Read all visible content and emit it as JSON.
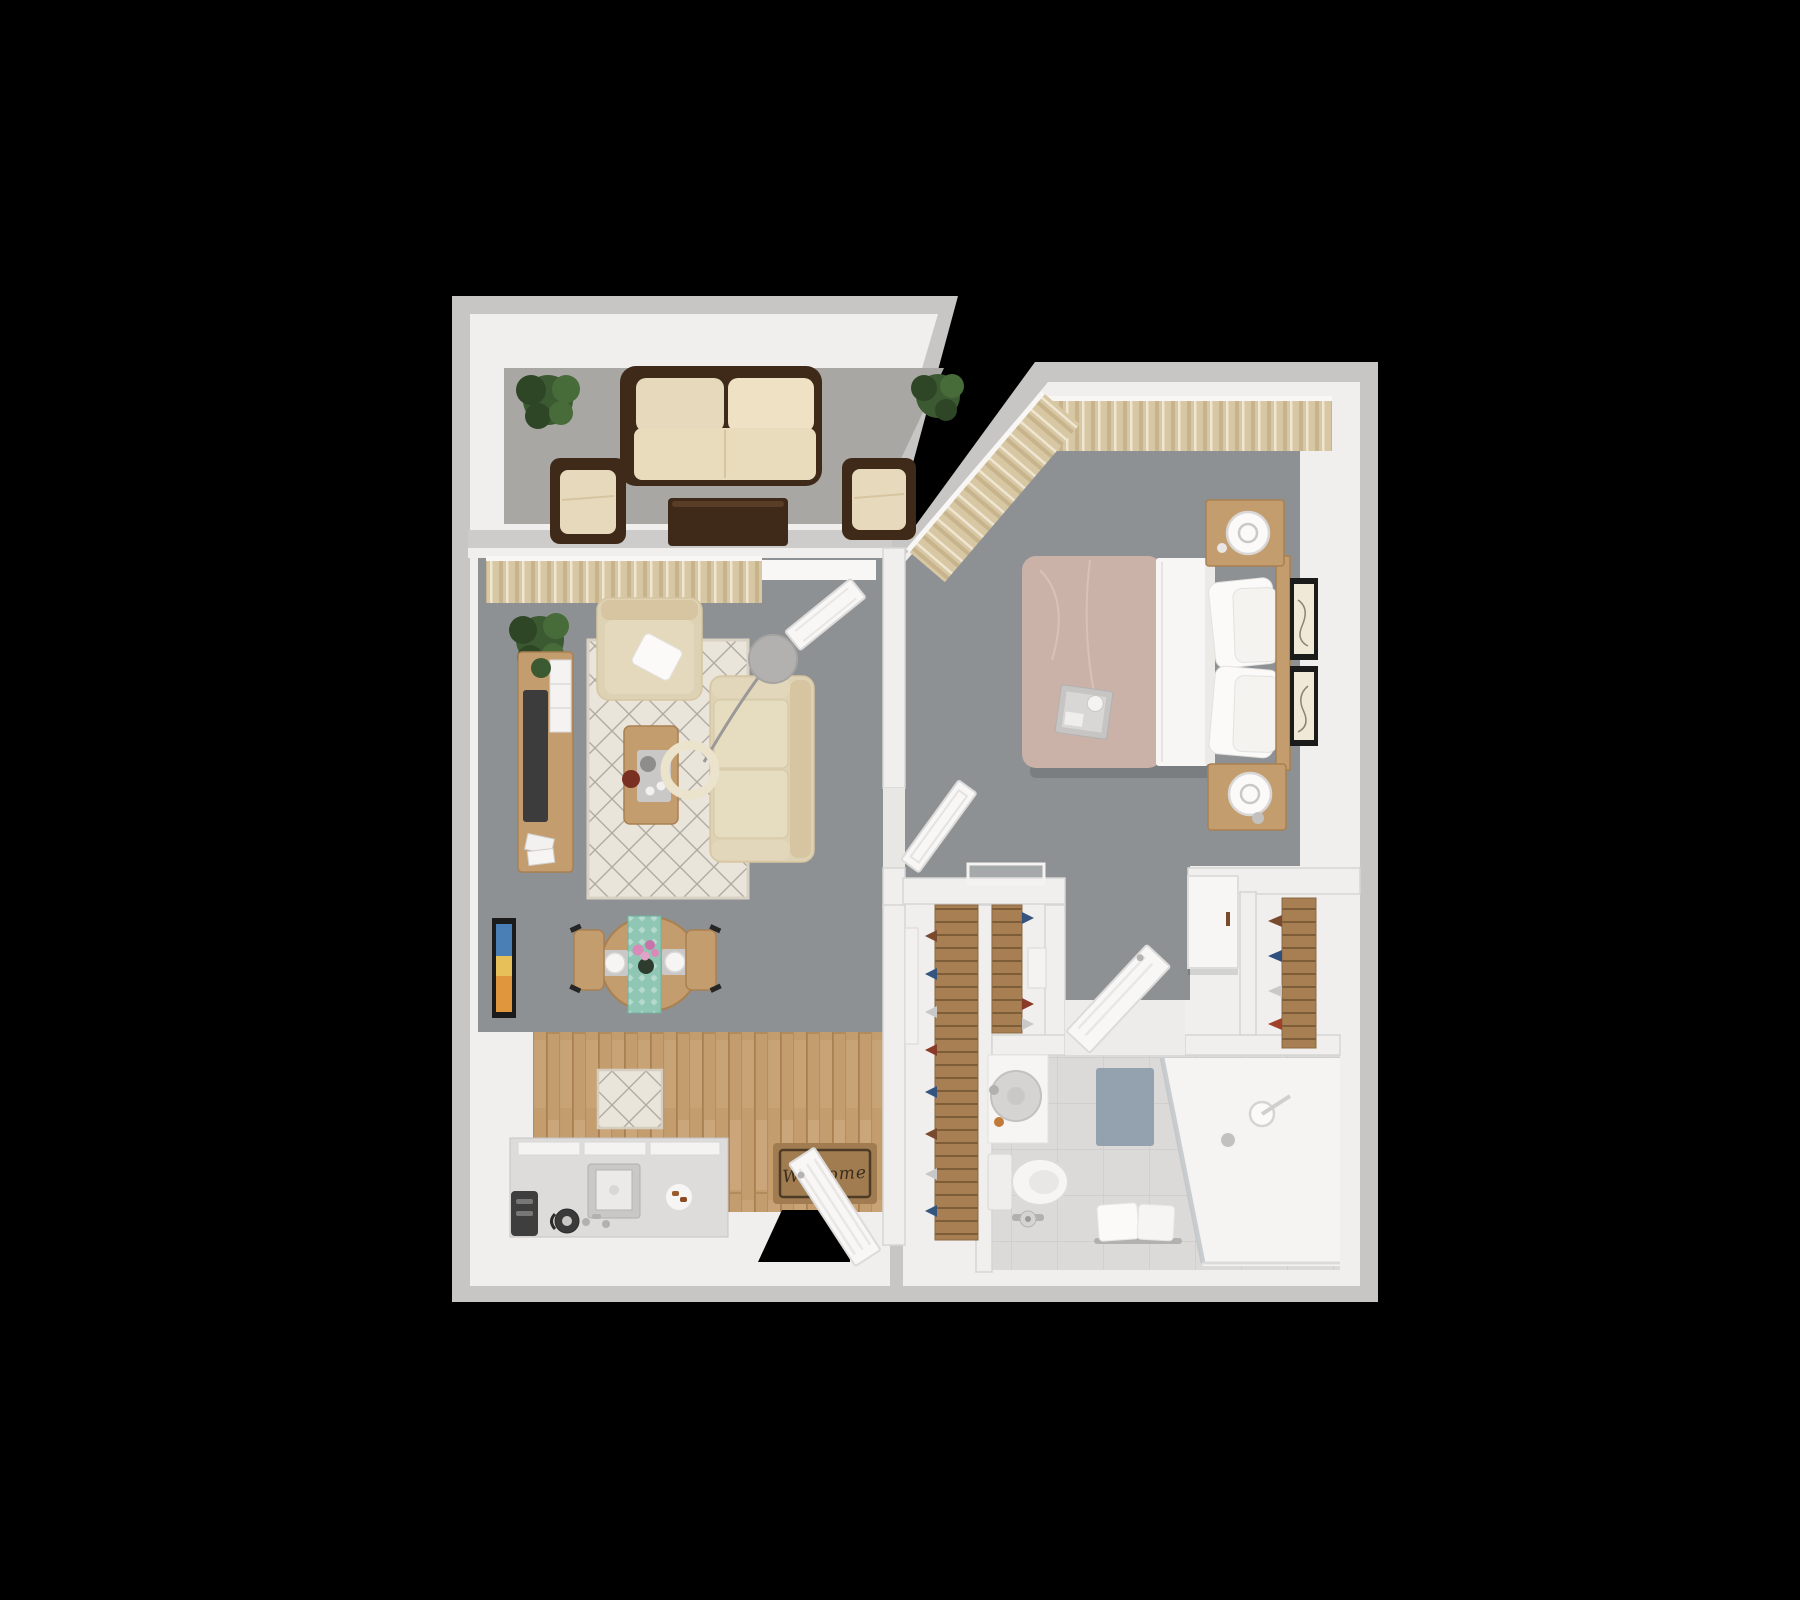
{
  "diagram_type": "3d-rendered apartment floor plan, top-down view, one bedroom one bath",
  "background": "black",
  "entry": {
    "welcome_mat_text": "Welcome"
  },
  "palette": {
    "bg": "#000000",
    "wallOuter": "#c7c6c4",
    "wallFace": "#f0efed",
    "balconyFloor": "#a8a7a4",
    "carpet": "#8e9193",
    "tileFloor": "#eae8e5",
    "bathTile": "#dbdad8",
    "wood": "#c49d6f",
    "rackWood": "#a87f52",
    "espresso": "#3f2a19",
    "cream": "#e7dabc",
    "sofaCream": "#ddd2b4",
    "rugBase": "#eae5db",
    "curtain": "#d8c7a3",
    "teal": "#8fc6b4",
    "blush": "#cbb2a9",
    "plant": "#3c5a32",
    "matBrown": "#a07c50",
    "rugBlue": "#8e9cab",
    "tvDark": "#3c3c3c",
    "doorWhite": "#f8f7f5"
  },
  "rooms": [
    {
      "name": "Balcony / Patio",
      "floor": "light gray carpet",
      "furniture": [
        "dark espresso loveseat with cream cushions",
        "two dark espresso armchairs with cream cushions",
        "dark espresso coffee table",
        "two potted plants"
      ]
    },
    {
      "name": "Living Room",
      "floor": "gray carpet",
      "furniture": [
        "tan curtains over sliding door",
        "potted plant",
        "cream armchair with white throw pillow",
        "diamond-pattern area rug",
        "cream sofa",
        "wood coffee table with tea tray and bowl",
        "arc floor lamp with gray shade and cream ring",
        "wood media console with TV, plant and magazines",
        "white door ajar to bedroom"
      ]
    },
    {
      "name": "Dining Area",
      "floor": "gray carpet",
      "furniture": [
        "round wood table",
        "teal patterned table runner",
        "two place settings with plates and cutlery",
        "pink flower centerpiece",
        "two wood chairs",
        "colorful framed wall art"
      ]
    },
    {
      "name": "Kitchen",
      "floor": "wood plank",
      "furniture": [
        "patterned kitchen rug",
        "white island counter with cabinet tops",
        "cooktop/sink unit with faucet",
        "black toaster",
        "black kettle",
        "plate of pastries"
      ]
    },
    {
      "name": "Entry",
      "floor": "white tile",
      "furniture": [
        "white entry door ajar over dark doorway",
        "brown welcome mat"
      ]
    },
    {
      "name": "Hallway Shoe Closet",
      "floor": "white tile",
      "furniture": [
        "tall wood shoe rack with shoes",
        "leaning white mirror"
      ]
    },
    {
      "name": "Bedroom",
      "floor": "gray carpet",
      "furniture": [
        "tan curtains on north and angled window walls",
        "queen bed with blush duvet, white sheet and four pillows",
        "wood headboard",
        "two wood nightstands",
        "two white desk fans",
        "two black framed art prints",
        "gray breakfast tray on bed",
        "leaning white mirror",
        "white floor tray"
      ]
    },
    {
      "name": "Walk-in Closet",
      "floor": "white tile",
      "furniture": [
        "wood shoe shelf with shoes",
        "white storage shelf",
        "white door ajar"
      ]
    },
    {
      "name": "Wardrobe Closet",
      "floor": "white tile",
      "furniture": [
        "wood shelving with folded clothes",
        "white wall-mounted cabinet with wood handle"
      ]
    },
    {
      "name": "Bathroom",
      "floor": "light tile grid",
      "furniture": [
        "white vanity with round gray basin and soap",
        "toilet with tank",
        "toilet paper stand",
        "blue-gray bath rug",
        "bench with two white towels",
        "glass walk-in shower with shower head and drain"
      ]
    }
  ]
}
